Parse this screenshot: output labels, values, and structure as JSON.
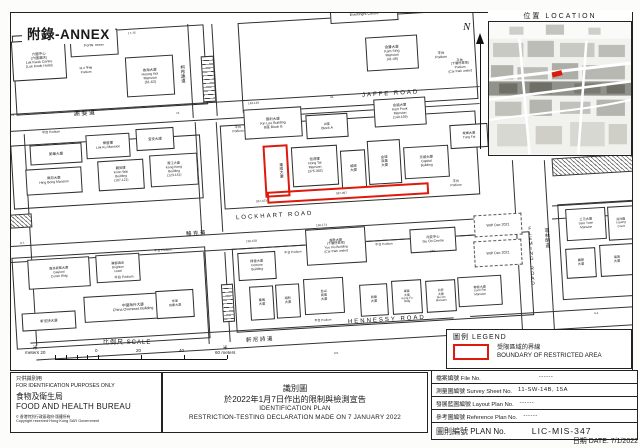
{
  "annex": {
    "label": "附錄-ANNEX"
  },
  "north": {
    "label": "N"
  },
  "location": {
    "title": "位置  LOCATION"
  },
  "scale": {
    "title": "比例尺  SCALE",
    "left_unit": "米",
    "left_label": "meters 20",
    "tick0": "0",
    "tick20": "20",
    "tick40": "40",
    "right_unit": "米",
    "right_label": "60 meters"
  },
  "legend": {
    "title": "圖例 LEGEND",
    "line1": "受限區域的界線",
    "line2": "BOUNDARY OF RESTRICTED AREA"
  },
  "footer": {
    "left": {
      "line1": "只供識別用",
      "line2": "FOR IDENTIFICATION PURPOSES ONLY",
      "zh": "食物及衛生局",
      "en": "FOOD AND HEALTH BUREAU",
      "copy_symbol": "©",
      "copy1": "香港特別行政區政府‧版權所有",
      "copy2": "Copyright reserved‧Hong Kong SAR Government"
    },
    "center": {
      "zh1": "識別圖",
      "zh2": "於2022年1月7日作出的限制與檢測宣告",
      "en1": "IDENTIFICATION PLAN",
      "en2": "RESTRICTION-TESTING DECLARATION MADE ON 7 JANUARY 2022"
    }
  },
  "info_table": {
    "rows": [
      {
        "label": "檔案編號 File No.",
        "value": "------",
        "cls": "gap"
      },
      {
        "label": "測量圖編號 Survey Sheet No.",
        "value": "11-SW-14B, 15A",
        "cls": ""
      },
      {
        "label": "發展藍圖編號 Layout Plan No.",
        "value": "------",
        "cls": ""
      },
      {
        "label": "參考圖編號 Reference Plan No.",
        "value": "------",
        "cls": ""
      }
    ],
    "plan_label": "圖則編號  PLAN  No.",
    "plan_value": "LIC-MIS-347",
    "date": "日期  DATE:  7/1/2022"
  },
  "map": {
    "items": [
      {
        "t": "block",
        "x": 14,
        "y": 30,
        "w": 192,
        "h": 80
      },
      {
        "t": "block",
        "x": 240,
        "y": 16,
        "w": 236,
        "h": 90
      },
      {
        "t": "block",
        "x": 12,
        "y": 140,
        "w": 190,
        "h": 64
      },
      {
        "t": "block",
        "x": 222,
        "y": 118,
        "w": 256,
        "h": 84
      },
      {
        "t": "block",
        "x": 14,
        "y": 252,
        "w": 194,
        "h": 92
      },
      {
        "t": "block",
        "x": 234,
        "y": 240,
        "w": 298,
        "h": 84
      },
      {
        "t": "block",
        "x": 560,
        "y": 202,
        "w": 76,
        "h": 96
      },
      {
        "t": "hline",
        "x": 10,
        "y": 100,
        "w": 470
      },
      {
        "t": "hline",
        "x": 10,
        "y": 117,
        "w": 470
      },
      {
        "t": "hline",
        "x": 10,
        "y": 231,
        "w": 508
      },
      {
        "t": "hline",
        "x": 10,
        "y": 247,
        "w": 508
      },
      {
        "t": "hline",
        "x": 552,
        "y": 203,
        "w": 86
      },
      {
        "t": "hline",
        "x": 552,
        "y": 216,
        "w": 86
      },
      {
        "t": "hline",
        "x": 30,
        "y": 330,
        "w": 424
      },
      {
        "t": "hline",
        "x": 36,
        "y": 347,
        "w": 420
      },
      {
        "t": "hline",
        "x": 470,
        "y": 311,
        "w": 168
      },
      {
        "t": "hline",
        "x": 470,
        "y": 329,
        "w": 168
      },
      {
        "t": "vline",
        "x": 190,
        "y": 24,
        "h": 94
      },
      {
        "t": "vline",
        "x": 214,
        "y": 24,
        "h": 92
      },
      {
        "t": "vline",
        "x": 198,
        "y": 122,
        "h": 112
      },
      {
        "t": "vline",
        "x": 219,
        "y": 122,
        "h": 110
      },
      {
        "t": "vline",
        "x": 206,
        "y": 252,
        "h": 92
      },
      {
        "t": "vline",
        "x": 227,
        "y": 252,
        "h": 90
      },
      {
        "t": "vline",
        "x": 518,
        "y": 160,
        "h": 206
      },
      {
        "t": "vline",
        "x": 550,
        "y": 160,
        "h": 208
      },
      {
        "t": "vline",
        "x": 30,
        "y": 134,
        "h": 212
      },
      {
        "t": "ladder",
        "x": 202,
        "y": 56,
        "w": 13,
        "h": 46
      },
      {
        "t": "ladder",
        "x": 222,
        "y": 284,
        "w": 12,
        "h": 38
      },
      {
        "t": "hatch",
        "x": 10,
        "y": 214,
        "w": 22,
        "h": 14
      },
      {
        "t": "hatch",
        "x": 552,
        "y": 156,
        "w": 82,
        "h": 18
      },
      {
        "t": "bldg",
        "x": 12,
        "y": 40,
        "w": 54,
        "h": 40,
        "fs": 3.5,
        "ln": [
          "六國中心",
          "(六國酒店)",
          "Luk Kwok Centre",
          "(Luk Kwok Hotel)"
        ],
        "n": "bldg-luk-kwok-centre"
      },
      {
        "t": "bldg",
        "x": 70,
        "y": 30,
        "w": 48,
        "h": 26,
        "fs": 3.7,
        "ln": [
          "富通大廈",
          "Fortis Tower"
        ],
        "n": "bldg-fortis-tower"
      },
      {
        "t": "lbl",
        "x": 64,
        "y": 62,
        "w": 44,
        "h": 18,
        "fs": 3.2,
        "ln": [
          "M.4 平台",
          "Podium"
        ]
      },
      {
        "t": "bldg",
        "x": 126,
        "y": 56,
        "w": 48,
        "h": 40,
        "fs": 3.5,
        "ln": [
          "香海大廈",
          "Heung Hoi",
          "Mansion",
          "(61-63)"
        ],
        "n": "bldg-heung-hoi-mansion"
      },
      {
        "t": "bldg",
        "x": 330,
        "y": 2,
        "w": 68,
        "h": 20,
        "fs": 3.7,
        "ln": [
          "光大中心",
          "Everbright Centre"
        ],
        "n": "bldg-everbright-centre"
      },
      {
        "t": "bldg",
        "x": 366,
        "y": 36,
        "w": 52,
        "h": 34,
        "fs": 3.5,
        "ln": [
          "金聲大廈",
          "Kam Sing",
          "Mansion",
          "(41-49)"
        ],
        "n": "bldg-kam-sing-mansion"
      },
      {
        "t": "lbl",
        "x": 424,
        "y": 42,
        "w": 34,
        "h": 26,
        "fs": 3.5,
        "ln": [
          "平台",
          "Podium"
        ]
      },
      {
        "t": "lbl",
        "x": 436,
        "y": 46,
        "w": 48,
        "h": 40,
        "fs": 3.2,
        "ln": [
          "平台",
          "(下層停車場)",
          "Podium",
          "(Car Park under)"
        ]
      },
      {
        "t": "num",
        "x": 128,
        "y": 32,
        "fs": 3,
        "tx": "17-75"
      },
      {
        "t": "bldg",
        "x": 244,
        "y": 108,
        "w": 58,
        "h": 30,
        "fs": 3.5,
        "ln": [
          "建利大廈",
          "Kin Lee Building",
          "B座 Block B"
        ],
        "n": "bldg-kin-lee-building"
      },
      {
        "t": "bldg",
        "x": 306,
        "y": 114,
        "w": 42,
        "h": 24,
        "fs": 3.5,
        "ln": [
          "A座",
          "Block A"
        ]
      },
      {
        "t": "bldg",
        "x": 374,
        "y": 98,
        "w": 52,
        "h": 28,
        "fs": 3.4,
        "ln": [
          "金福大廈",
          "Kam Fook",
          "Mansion",
          "(149-159)"
        ],
        "n": "bldg-kam-fook-mansion"
      },
      {
        "t": "bldg",
        "x": 292,
        "y": 146,
        "w": 46,
        "h": 40,
        "fs": 3.4,
        "ln": [
          "恒達樓",
          "Hong Tat",
          "Mansion",
          "(375-383)"
        ],
        "n": "bldg-hong-tat-mansion"
      },
      {
        "t": "bldg",
        "x": 341,
        "y": 150,
        "w": 25,
        "h": 38,
        "fs": 3.4,
        "ln": [
          "城威",
          "大廈"
        ]
      },
      {
        "t": "bldg",
        "x": 368,
        "y": 140,
        "w": 33,
        "h": 44,
        "fs": 3.4,
        "ln": [
          "金城",
          "商業",
          "大廈"
        ]
      },
      {
        "t": "bldg",
        "x": 404,
        "y": 146,
        "w": 45,
        "h": 32,
        "fs": 3.4,
        "ln": [
          "京城大廈",
          "Capital",
          "Building"
        ],
        "n": "bldg-capital-building"
      },
      {
        "t": "bldg",
        "x": 30,
        "y": 144,
        "w": 52,
        "h": 20,
        "fs": 3.6,
        "ln": [
          "美華大廈"
        ]
      },
      {
        "t": "bldg",
        "x": 86,
        "y": 134,
        "w": 44,
        "h": 24,
        "fs": 3.4,
        "ln": [
          "樂居樓",
          "Lok Ku Mansion"
        ]
      },
      {
        "t": "bldg",
        "x": 136,
        "y": 128,
        "w": 38,
        "h": 22,
        "fs": 3.5,
        "ln": [
          "宜安大廈"
        ]
      },
      {
        "t": "bldg",
        "x": 26,
        "y": 168,
        "w": 56,
        "h": 26,
        "fs": 3.4,
        "ln": [
          "興邦大廈",
          "Hing Bong Mansion"
        ],
        "n": "bldg-hing-bong-mansion"
      },
      {
        "t": "bldg",
        "x": 98,
        "y": 160,
        "w": 46,
        "h": 30,
        "fs": 3.3,
        "ln": [
          "覲美樓",
          "Koon Wai",
          "Building",
          "(107-121)"
        ],
        "n": "bldg-koon-wai-building"
      },
      {
        "t": "bldg",
        "x": 150,
        "y": 154,
        "w": 48,
        "h": 32,
        "fs": 3.3,
        "ln": [
          "港江大廈",
          "Kong Kong",
          "Building",
          "(123-141)"
        ]
      },
      {
        "t": "lbl",
        "x": 226,
        "y": 116,
        "w": 24,
        "h": 28,
        "fs": 3.3,
        "ln": [
          "平台",
          "Podium"
        ]
      },
      {
        "t": "lbl",
        "x": 34,
        "y": 128,
        "w": 34,
        "h": 10,
        "fs": 3.2,
        "ln": [
          "平台 Podium"
        ]
      },
      {
        "t": "lbl",
        "x": 440,
        "y": 174,
        "w": 32,
        "h": 20,
        "fs": 3.3,
        "ln": [
          "平台",
          "Podium"
        ]
      },
      {
        "t": "bldg",
        "x": 450,
        "y": 124,
        "w": 38,
        "h": 24,
        "fs": 3.2,
        "ln": [
          "東輝大廈",
          "Tung Fai"
        ]
      },
      {
        "t": "bldg",
        "x": 238,
        "y": 252,
        "w": 38,
        "h": 28,
        "fs": 3.3,
        "ln": [
          "得發大廈",
          "Fortune",
          "Building"
        ]
      },
      {
        "t": "bldg",
        "x": 306,
        "y": 228,
        "w": 60,
        "h": 36,
        "fs": 3.2,
        "ln": [
          "越秀大廈",
          "(下層停車場)",
          "Yue Xiu Building",
          "(Car Park under)"
        ],
        "n": "bldg-yue-xiu-building"
      },
      {
        "t": "lbl",
        "x": 278,
        "y": 248,
        "w": 30,
        "h": 10,
        "fs": 3.1,
        "ln": [
          "平台 Podium"
        ]
      },
      {
        "t": "bldg",
        "x": 410,
        "y": 228,
        "w": 46,
        "h": 24,
        "fs": 3.4,
        "ln": [
          "兆安中心",
          "Siu On Centre"
        ],
        "n": "bldg-siu-on-centre"
      },
      {
        "t": "bldg",
        "x": 250,
        "y": 286,
        "w": 24,
        "h": 34,
        "fs": 3.2,
        "ln": [
          "萬鳴",
          "大廈"
        ]
      },
      {
        "t": "bldg",
        "x": 276,
        "y": 284,
        "w": 24,
        "h": 34,
        "fs": 3.2,
        "ln": [
          "順利",
          "大廈"
        ]
      },
      {
        "t": "bldg",
        "x": 304,
        "y": 278,
        "w": 40,
        "h": 36,
        "fs": 3.2,
        "ln": [
          "台山",
          "商業",
          "大廈"
        ]
      },
      {
        "t": "lbl",
        "x": 308,
        "y": 316,
        "w": 30,
        "h": 9,
        "fs": 3,
        "ln": [
          "平台 Podium"
        ]
      },
      {
        "t": "bldg",
        "x": 360,
        "y": 284,
        "w": 28,
        "h": 32,
        "fs": 3.2,
        "ln": [
          "眞榮",
          "大廈"
        ]
      },
      {
        "t": "bldg",
        "x": 392,
        "y": 280,
        "w": 30,
        "h": 34,
        "fs": 2.9,
        "ln": [
          "康富",
          "大廈",
          "Kong Fu",
          "Bldg"
        ]
      },
      {
        "t": "bldg",
        "x": 426,
        "y": 280,
        "w": 30,
        "h": 32,
        "fs": 2.9,
        "ln": [
          "兆安",
          "大廈",
          "Siu On",
          "Mansion"
        ]
      },
      {
        "t": "bldg",
        "x": 458,
        "y": 276,
        "w": 44,
        "h": 30,
        "fs": 3.1,
        "ln": [
          "聯發大廈",
          "Luen Fat",
          "Mansion"
        ],
        "n": "bldg-luen-fat-mansion"
      },
      {
        "t": "lbl",
        "x": 370,
        "y": 240,
        "w": 28,
        "h": 10,
        "fs": 3.1,
        "ln": [
          "平台 Podium"
        ]
      },
      {
        "t": "bldg",
        "x": 28,
        "y": 258,
        "w": 62,
        "h": 30,
        "fs": 3.2,
        "ln": [
          "嘉洛商業大廈",
          "Gaylord",
          "Comm Bldg"
        ],
        "n": "bldg-gaylord-commercial"
      },
      {
        "t": "bldg",
        "x": 96,
        "y": 254,
        "w": 44,
        "h": 28,
        "fs": 3.2,
        "ln": [
          "麗都酒店",
          "Brighton",
          "Hotel"
        ]
      },
      {
        "t": "lbl",
        "x": 146,
        "y": 246,
        "w": 34,
        "h": 10,
        "fs": 3.1,
        "ln": [
          "平台 Podium"
        ]
      },
      {
        "t": "lbl",
        "x": 106,
        "y": 272,
        "w": 36,
        "h": 12,
        "fs": 3.4,
        "ln": [
          "平台 Podium"
        ]
      },
      {
        "t": "bldg",
        "x": 84,
        "y": 294,
        "w": 98,
        "h": 26,
        "fs": 3.7,
        "ln": [
          "中國海外大廈",
          "China Overseas Building"
        ],
        "n": "bldg-china-overseas"
      },
      {
        "t": "bldg",
        "x": 156,
        "y": 290,
        "w": 38,
        "h": 28,
        "fs": 3.1,
        "ln": [
          "世運",
          "商業大廈"
        ]
      },
      {
        "t": "bldg",
        "x": 22,
        "y": 312,
        "w": 54,
        "h": 18,
        "fs": 3.5,
        "ln": [
          "軒尼詩大廈"
        ]
      },
      {
        "t": "dashed",
        "x": 474,
        "y": 214,
        "w": 48,
        "h": 22,
        "fs": 3.6,
        "ln": [
          "WIP Dec 2021"
        ]
      },
      {
        "t": "dashed",
        "x": 474,
        "y": 240,
        "w": 48,
        "h": 26,
        "fs": 3.6,
        "ln": [
          "WIP Dec 2021"
        ]
      },
      {
        "t": "bldg",
        "x": 566,
        "y": 208,
        "w": 40,
        "h": 32,
        "fs": 3.2,
        "ln": [
          "三元大廈",
          "Sam Yuen",
          "Mansion"
        ],
        "n": "bldg-sam-yuen-mansion"
      },
      {
        "t": "bldg",
        "x": 608,
        "y": 206,
        "w": 26,
        "h": 34,
        "fs": 3,
        "ln": [
          "凌洋閣",
          "Loyang",
          "Court"
        ]
      },
      {
        "t": "bldg",
        "x": 566,
        "y": 248,
        "w": 30,
        "h": 30,
        "fs": 3.2,
        "ln": [
          "廣德",
          "大廈"
        ]
      },
      {
        "t": "bldg",
        "x": 600,
        "y": 244,
        "w": 34,
        "h": 32,
        "fs": 3.2,
        "ln": [
          "海灣",
          "大廈"
        ]
      },
      {
        "t": "num",
        "x": 10,
        "y": 114,
        "fs": 3,
        "tx": "3.3."
      },
      {
        "t": "num",
        "x": 176,
        "y": 112,
        "fs": 3,
        "tx": "74."
      },
      {
        "t": "num",
        "x": 330,
        "y": 96,
        "fs": 3,
        "tx": "44."
      },
      {
        "t": "num",
        "x": 248,
        "y": 102,
        "fs": 3,
        "tx": "143-149"
      },
      {
        "t": "num",
        "x": 256,
        "y": 200,
        "fs": 3,
        "tx": "367-373"
      },
      {
        "t": "num",
        "x": 336,
        "y": 192,
        "fs": 3,
        "tx": "387-397"
      },
      {
        "t": "num",
        "x": 246,
        "y": 240,
        "fs": 3,
        "tx": "150-158"
      },
      {
        "t": "num",
        "x": 316,
        "y": 224,
        "fs": 3,
        "tx": "160-174"
      },
      {
        "t": "num",
        "x": 430,
        "y": 250,
        "fs": 3,
        "tx": "188"
      },
      {
        "t": "num",
        "x": 20,
        "y": 242,
        "fs": 3,
        "tx": "3.7."
      },
      {
        "t": "num",
        "x": 334,
        "y": 352,
        "fs": 3,
        "tx": "3.6."
      },
      {
        "t": "num",
        "x": 594,
        "y": 312,
        "fs": 3,
        "tx": "4.4."
      },
      {
        "t": "red",
        "x": 264,
        "y": 145,
        "w": 25,
        "h": 52,
        "n": "restricted-area-boundary-vertical"
      },
      {
        "t": "red",
        "x": 267,
        "y": 187,
        "w": 162,
        "h": 12,
        "n": "restricted-area-boundary-strip"
      },
      {
        "t": "vtext",
        "x": 270,
        "y": 150,
        "w": 14,
        "h": 42,
        "fs": 3.8,
        "tx": "東成大廈",
        "n": "bldg-restricted"
      },
      {
        "t": "roaden",
        "x": 362,
        "y": 91,
        "fs": 6,
        "tx": "JAFFE  ROAD",
        "n": "road-jaffe"
      },
      {
        "t": "roadzh",
        "x": 74,
        "y": 111,
        "fs": 6,
        "tx": "謝斐道",
        "n": "road-jaffe-zh"
      },
      {
        "t": "roaden",
        "x": 236,
        "y": 213,
        "fs": 6,
        "tx": "LOCKHART  ROAD",
        "n": "road-lockhart"
      },
      {
        "t": "roadzh",
        "x": 186,
        "y": 231,
        "fs": 5.5,
        "tx": "駱克道",
        "n": "road-lockhart-zh"
      },
      {
        "t": "roaden",
        "x": 348,
        "y": 317,
        "fs": 6,
        "tx": "HENNESSY  ROAD",
        "n": "road-hennessy"
      },
      {
        "t": "roadzh",
        "x": 246,
        "y": 337,
        "fs": 5.5,
        "tx": "軒尼詩道",
        "n": "road-hennessy-zh"
      },
      {
        "t": "vtext",
        "x": 524,
        "y": 210,
        "w": 9,
        "h": 92,
        "fs": 4.6,
        "tx": "FLEMING ROAD",
        "n": "road-fleming"
      },
      {
        "t": "vtext",
        "x": 540,
        "y": 214,
        "w": 9,
        "h": 48,
        "fs": 5,
        "tx": "菲林明道",
        "n": "road-fleming-zh"
      },
      {
        "t": "vtext",
        "x": 176,
        "y": 52,
        "w": 9,
        "h": 44,
        "fs": 4.5,
        "tx": "柯布連道",
        "n": "road-obrien-zh"
      }
    ]
  }
}
